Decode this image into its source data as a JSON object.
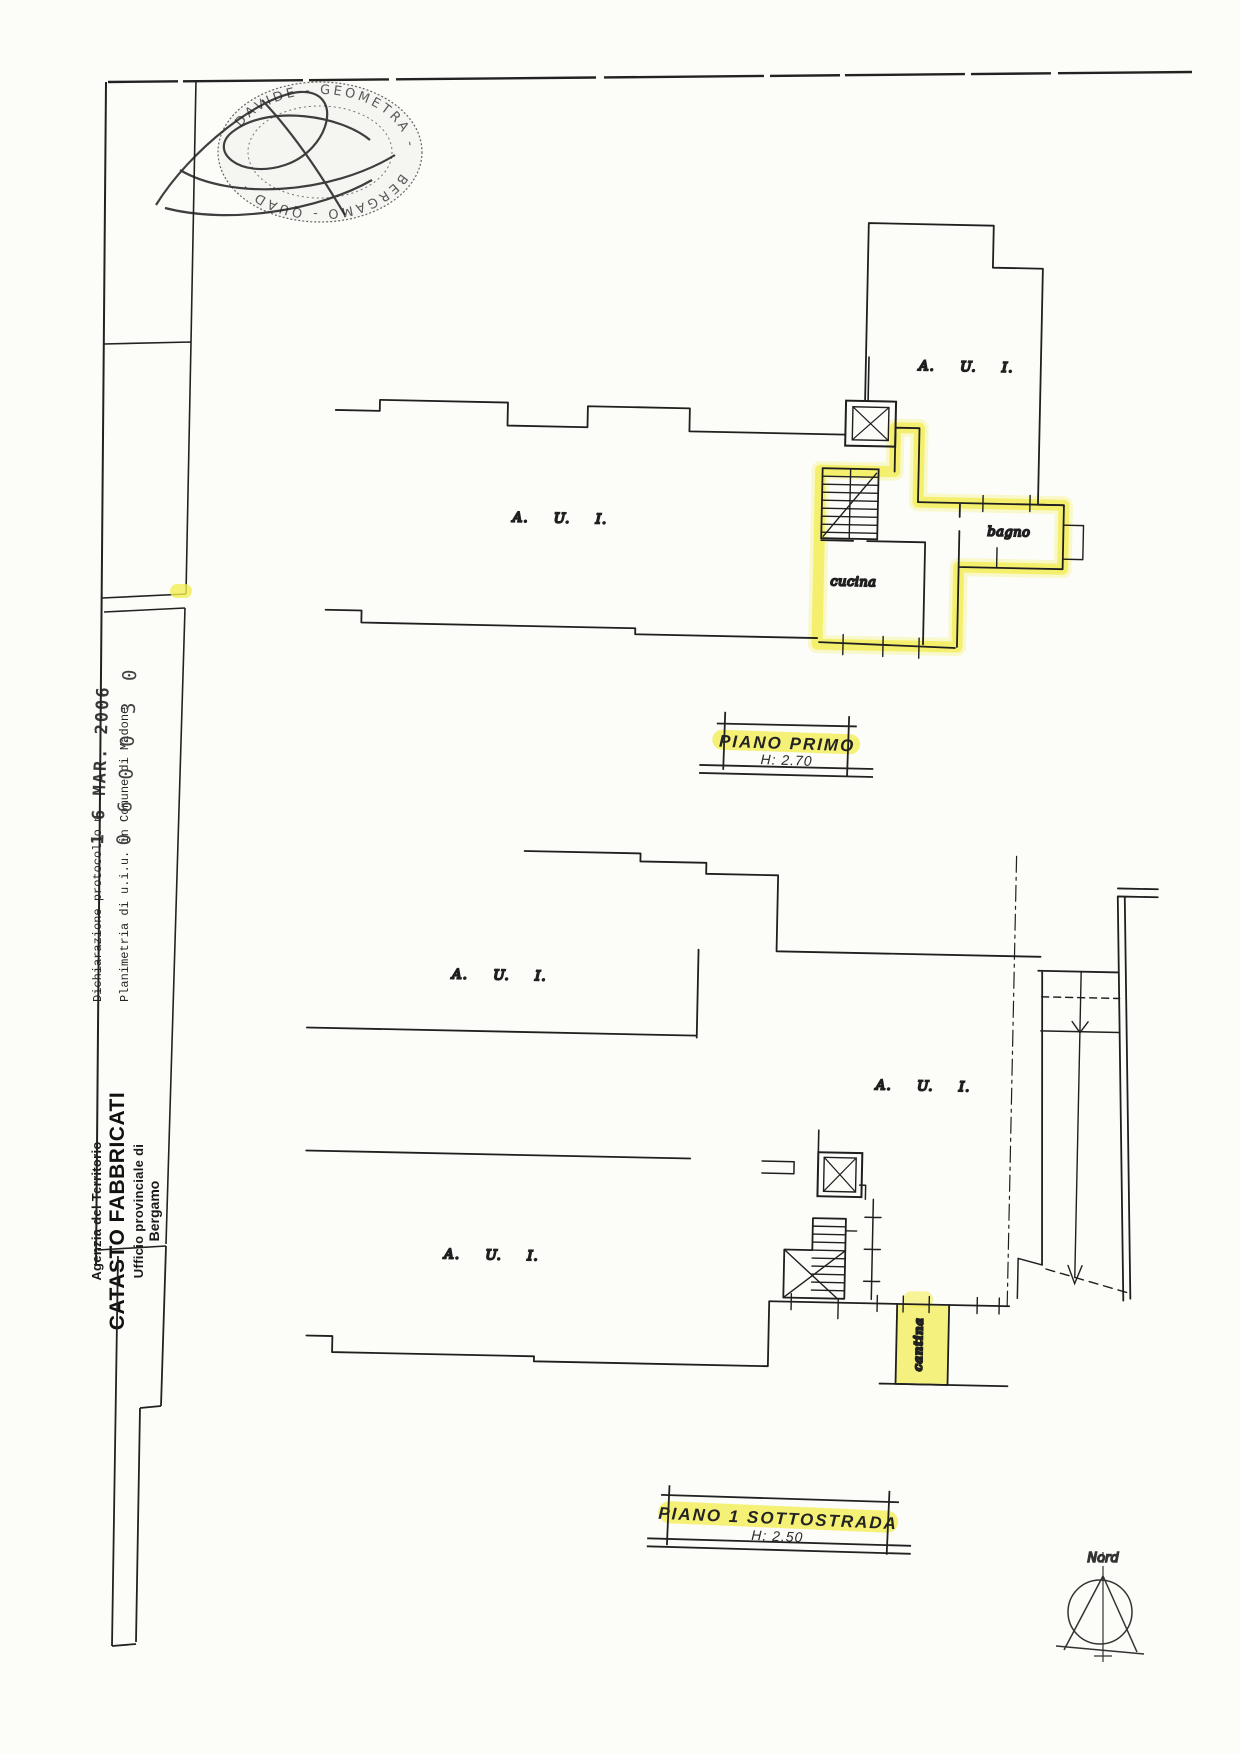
{
  "colors": {
    "highlight": "#f2ee55",
    "ink": "#1f1f1f",
    "paper": "#fcfcf9"
  },
  "header_strip": {
    "agency_small": "Agenzia del Territorio",
    "agency_main": "CATASTO FABBRICATI",
    "office_line": "Ufficio provinciale di",
    "office_city": "Bergamo",
    "declaration_line": "Dichiarazione protocollo n.",
    "planimetry_line": "Planimetria di u.i.u. in Comune di Madone",
    "protocol_date": "1 6 MAR. 2006",
    "protocol_number": "0 6 0 0 3 0"
  },
  "stamp": {
    "arc_top": "DAVIDE - GEOMETRA -",
    "arc_bottom": "BERGAMO - QUAD -"
  },
  "floor_plans": {
    "piano_primo": {
      "caption": "PIANO PRIMO",
      "height": "H: 2.70",
      "labels": {
        "aui_left": "A. U. I.",
        "aui_right": "A. U. I.",
        "cucina": "cucina",
        "bagno": "bagno"
      }
    },
    "piano_sottostrada": {
      "caption": "PIANO 1 SOTTOSTRADA",
      "height": "H: 2.50",
      "labels": {
        "aui_top_left": "A. U. I.",
        "aui_right": "A. U. I.",
        "aui_bottom_left": "A. U. I.",
        "cantina": "cantina"
      }
    }
  },
  "compass": {
    "label": "Nord"
  }
}
